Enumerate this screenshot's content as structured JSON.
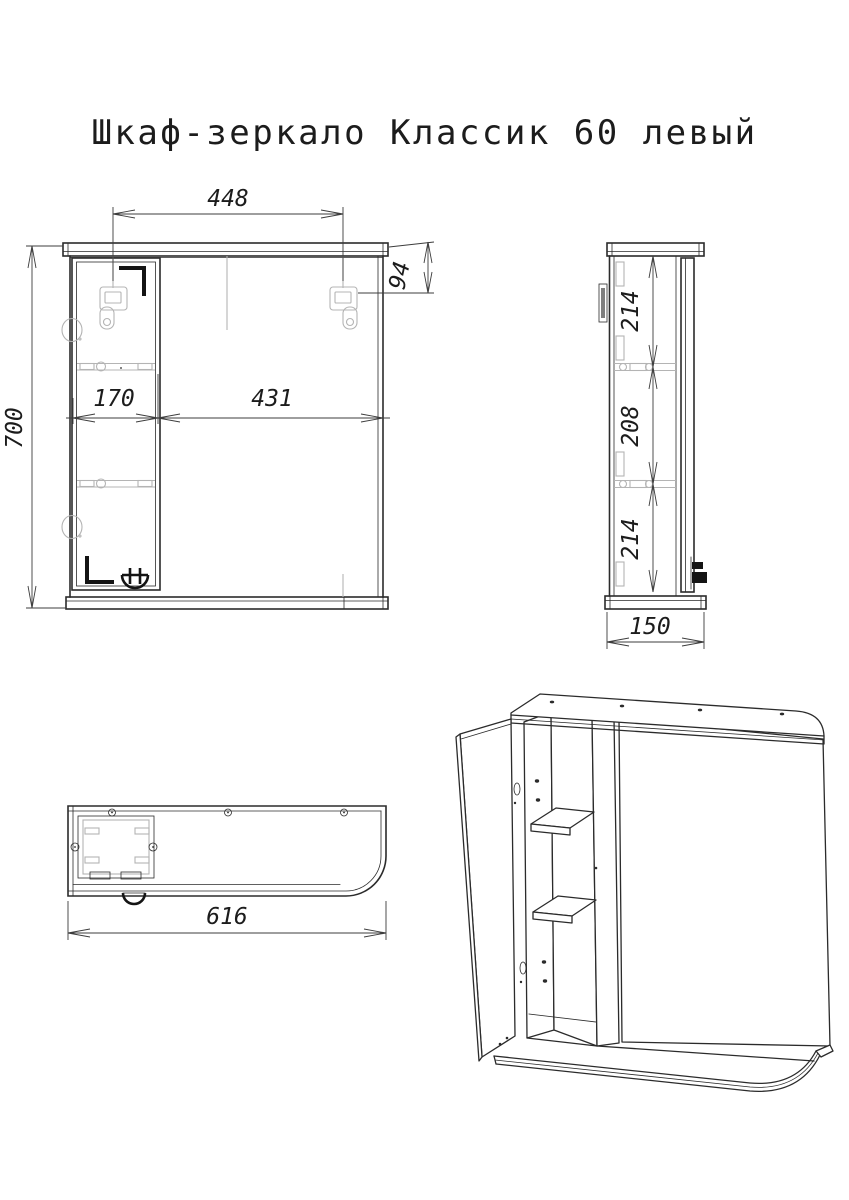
{
  "title": "Шкаф-зеркало Классик 60 левый",
  "drawing": {
    "front_view": {
      "dims": {
        "top_width": "448",
        "bracket_offset": "94",
        "door_width": "170",
        "mirror_width": "431",
        "height": "700"
      }
    },
    "side_view": {
      "dims": {
        "upper_section": "214",
        "middle_section": "208",
        "lower_section": "214",
        "depth": "150"
      }
    },
    "top_view": {
      "dims": {
        "width": "616"
      }
    }
  },
  "colors": {
    "line": "#2b2b2b",
    "detail_gray": "#b4b4b4",
    "background": "#ffffff"
  }
}
